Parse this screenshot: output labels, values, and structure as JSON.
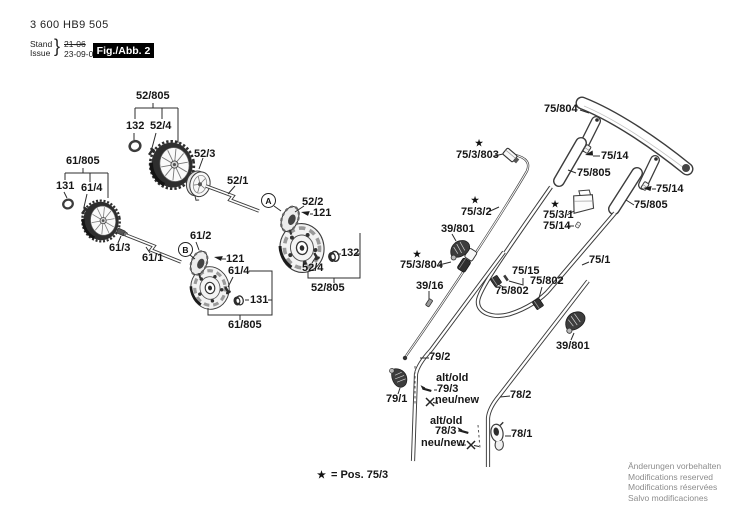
{
  "header": {
    "part_number": "3 600 HB9 505",
    "stand_label": "Stand",
    "issue_label": "Issue",
    "brace": "}",
    "date_old": "21-06",
    "date_new": "23-09-08",
    "figure_label": "Fig./Abb. 2"
  },
  "symbols": {
    "star": "★"
  },
  "markers": {
    "a": "A",
    "b": "B"
  },
  "parts": {
    "p52805_top": "52/805",
    "p132_top": "132",
    "p524_top": "52/4",
    "p523": "52/3",
    "p521": "52/1",
    "p522": "52/2",
    "p121_a": "121",
    "p132_b": "132",
    "p524_b": "52/4",
    "p52805_b": "52/805",
    "p61805_top": "61/805",
    "p131_top": "131",
    "p614_top": "61/4",
    "p613": "61/3",
    "p611": "61/1",
    "p612": "61/2",
    "p121_b": "121",
    "p614_b": "61/4",
    "p131_b": "131",
    "p61805_b": "61/805",
    "p75804": "75/804",
    "p753803": "75/3/803",
    "p7514_1": "75/14",
    "p75805_1": "75/805",
    "p7514_2": "75/14",
    "p75805_2": "75/805",
    "p7532": "75/3/2",
    "p7531": "75/3/1",
    "p7514_3": "75/14",
    "p39801_l": "39/801",
    "p753804": "75/3/804",
    "p3916": "39/16",
    "p7515": "75/15",
    "p75802_l": "75/802",
    "p75802_r": "75/802",
    "p751": "75/1",
    "p39801_r": "39/801",
    "p792": "79/2",
    "p791": "79/1",
    "p793": "79/3",
    "alt_old_79": "alt/old",
    "neu_new_79": "neu/new",
    "p782": "78/2",
    "p783": "78/3",
    "alt_old_78": "alt/old",
    "neu_new_78": "neu/new",
    "p781": "78/1"
  },
  "footer": {
    "legend": "= Pos. 75/3",
    "notes": [
      "Änderungen vorbehalten",
      "Modifications reserved",
      "Modifications réservées",
      "Salvo modificaciones"
    ]
  }
}
